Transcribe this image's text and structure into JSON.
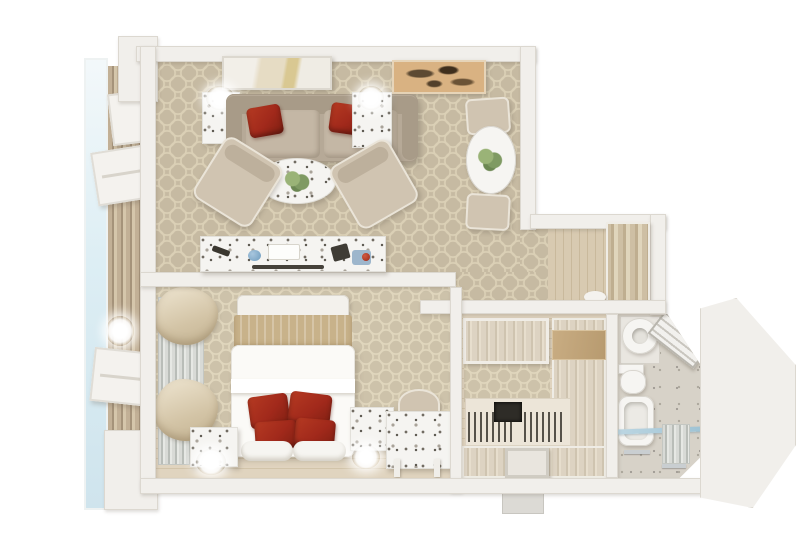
{
  "scene": {
    "type": "3d-floor-plan-render",
    "description": "Top-down 3D cutaway render of a one-bedroom apartment with balcony on a plain white background; no text labels visible",
    "rooms": [
      {
        "id": "balcony",
        "label": "balcony",
        "furniture": [
          "glass railing",
          "wood slat deck",
          "fold-down table",
          "folding chair",
          "wall lamp",
          "folding chair"
        ]
      },
      {
        "id": "living-room",
        "label": "living room",
        "furniture": [
          "abstract painting",
          "side table with lamp",
          "taupe sofa with two red pillows",
          "side table with lamp",
          "oval marble coffee table with plant",
          "armchair",
          "armchair",
          "marble media console with decor objects",
          "patterned beige carpet",
          "window curtains"
        ]
      },
      {
        "id": "dining-nook",
        "label": "dining nook",
        "furniture": [
          "abstract painting",
          "round white pedestal table with plant",
          "dining chair",
          "dining chair"
        ]
      },
      {
        "id": "hallway",
        "label": "entry hallway",
        "furniture": [
          "wood-panel entry door",
          "wood entry floor",
          "shoes by door"
        ]
      },
      {
        "id": "bedroom",
        "label": "bedroom",
        "furniture": [
          "headboard",
          "double bed with white duvet and four red pillows",
          "nightstand with lamp",
          "nightstand with lamp",
          "marble desk with chair",
          "window radiator",
          "curtains",
          "wood floor strip"
        ]
      },
      {
        "id": "walk-in-closet",
        "label": "walk-in closet",
        "furniture": [
          "upper cabinet",
          "tall wardrobe",
          "hanging rail with clothes",
          "drawer island",
          "hanging rail with clothes",
          "stool",
          "service shaft"
        ]
      },
      {
        "id": "bathroom",
        "label": "bathroom",
        "furniture": [
          "round sink on vanity",
          "corner shelf unit on chamfered wall",
          "toilet",
          "bathtub with glass screen",
          "radiator",
          "towel rails"
        ]
      }
    ]
  },
  "palette": {
    "bg": "#ffffff",
    "wall": "#f1efeb",
    "wall-edge": "#dcd8d0",
    "carpet": "#c6baa2",
    "carpet-line": "#dbd0b6",
    "bed-carpet": "#cdc2aa",
    "bed-carpet-line": "#e0d6bd",
    "wood-floor": "#e0d4bf",
    "wood-floor-line": "#d2c4aa",
    "wood-grain": "#ddd3c2",
    "entry-wood": "#d8cab1",
    "door-wood": "#cebfa4",
    "slat-wood": "#c2b096",
    "slat-wood-dark": "#a5937a",
    "glass": "#cfe4ed",
    "sofa": "#b6a997",
    "sofa-cushion": "#c4b7a5",
    "sofa-arm": "#a89b88",
    "chair": "#d0c4b1",
    "red": "#a1291b",
    "red-dark": "#7e1f12",
    "marble": "#f5f4f1",
    "speck": "#6f6a60",
    "tan-band": "#c8b28a",
    "painting-tan": "#d9b282",
    "paint-dark": "#5d4a33",
    "plant": "#7f9a63",
    "tile": "#d7d2c8",
    "fixture": "#f6f5f2",
    "chrome": "#c9ced1",
    "radiator": "#b9bdb8"
  }
}
